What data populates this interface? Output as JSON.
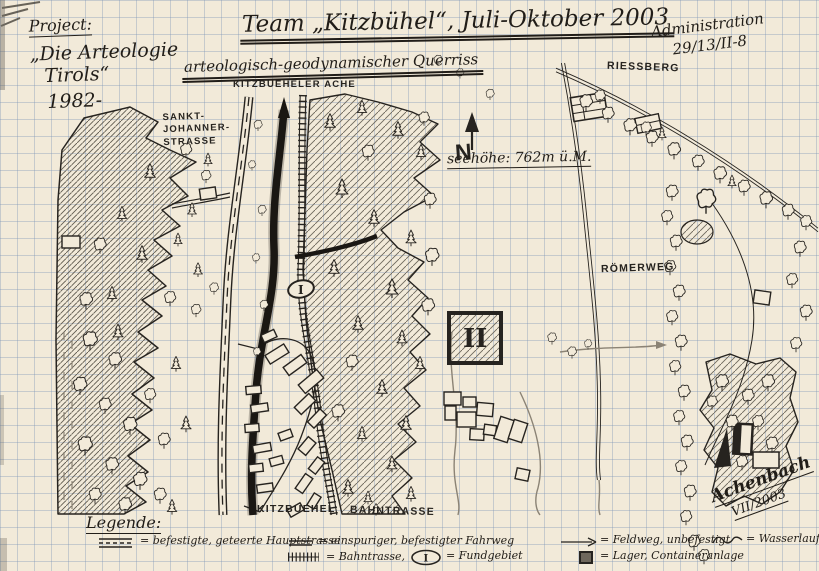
{
  "project": {
    "title": "Project:",
    "line1": "„Die Arteologie",
    "line2": "Tirols“",
    "line3": "1982-"
  },
  "header": {
    "team_title": "Team „Kitzbühel“, Juli-Oktober 2003",
    "subtitle": "arteologisch-geodynamischer Querriss"
  },
  "admin": {
    "line1": "Administration",
    "line2": "29/13/II-8"
  },
  "map": {
    "labels": {
      "river": "KITZBUEHELER ACHE",
      "street_l1": "SANKT-",
      "street_l2": "JOHANNER-",
      "street_l3": "STRASSE",
      "riessberg": "RIESSBERG",
      "roemerweg": "RÖMERWEG",
      "town": "KITZBUEHEL",
      "railway": "BAHNTRASSE",
      "elevation": "seehöhe: 762m ü.M.",
      "compass": "N",
      "fund_site_marker": "II",
      "find_area_marker": "I"
    }
  },
  "legend": {
    "title": "Legende:",
    "items": {
      "main_road": "= befestigte, geteerte Hauptstrasse",
      "single_road": "= einspuriger, befestigter Fahrweg",
      "field_path": "= Feldweg, unbefestigt",
      "stream": "= Wasserlauf",
      "railway": "= Bahntrasse,",
      "find_area": "= Fundgebiet",
      "camp": "= Lager, Containeranlage"
    }
  },
  "signature": {
    "name": "Achenbach",
    "date": "VII/2003"
  },
  "colors": {
    "paper": "#f2ead9",
    "grid": "#7d96b9",
    "ink": "#26231f",
    "pencil": "#8b8375"
  }
}
